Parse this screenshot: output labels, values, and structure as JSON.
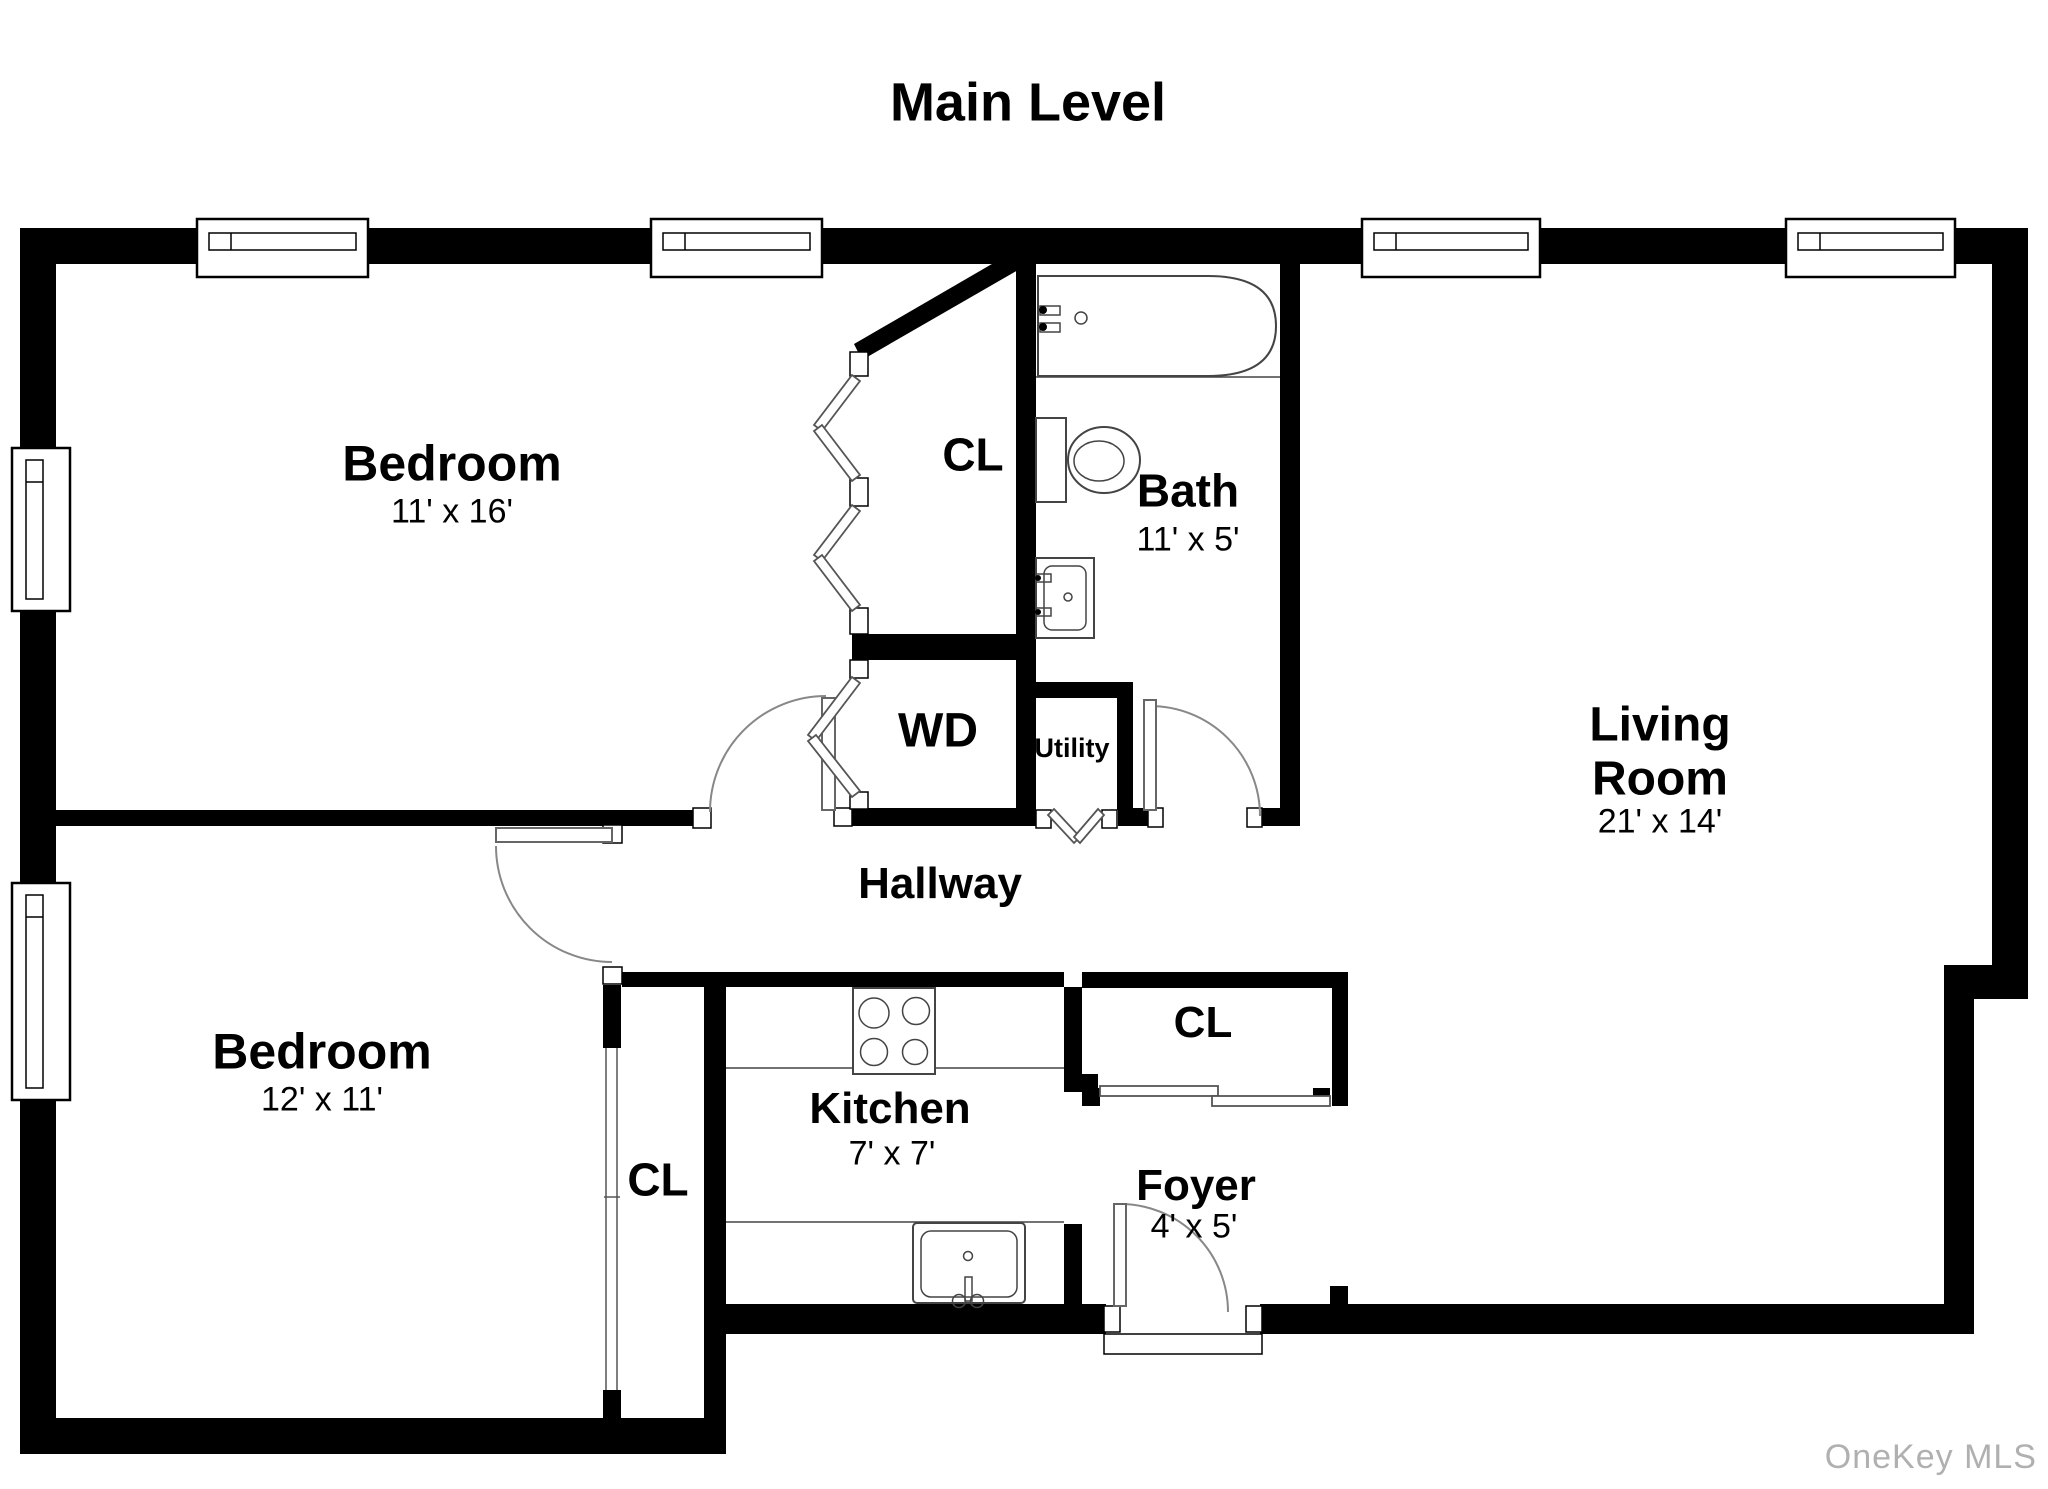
{
  "title": "Main Level",
  "watermark": "OneKey MLS",
  "colors": {
    "wall": "#000000",
    "background": "#ffffff",
    "watermark": "#b0b0b0"
  },
  "rooms": {
    "bedroom1": {
      "name": "Bedroom",
      "dims": "11' x 16'"
    },
    "closet_top": {
      "name": "CL"
    },
    "bath": {
      "name": "Bath",
      "dims": "11' x 5'"
    },
    "living_room": {
      "name": "Living Room",
      "dims": "21' x 14'"
    },
    "wd": {
      "name": "WD"
    },
    "utility": {
      "name": "Utility"
    },
    "hallway": {
      "name": "Hallway"
    },
    "bedroom2": {
      "name": "Bedroom",
      "dims": "12' x 11'"
    },
    "closet_bedroom2": {
      "name": "CL"
    },
    "kitchen": {
      "name": "Kitchen",
      "dims": "7' x 7'"
    },
    "closet_foyer": {
      "name": "CL"
    },
    "foyer": {
      "name": "Foyer",
      "dims": "4' x 5'"
    }
  }
}
